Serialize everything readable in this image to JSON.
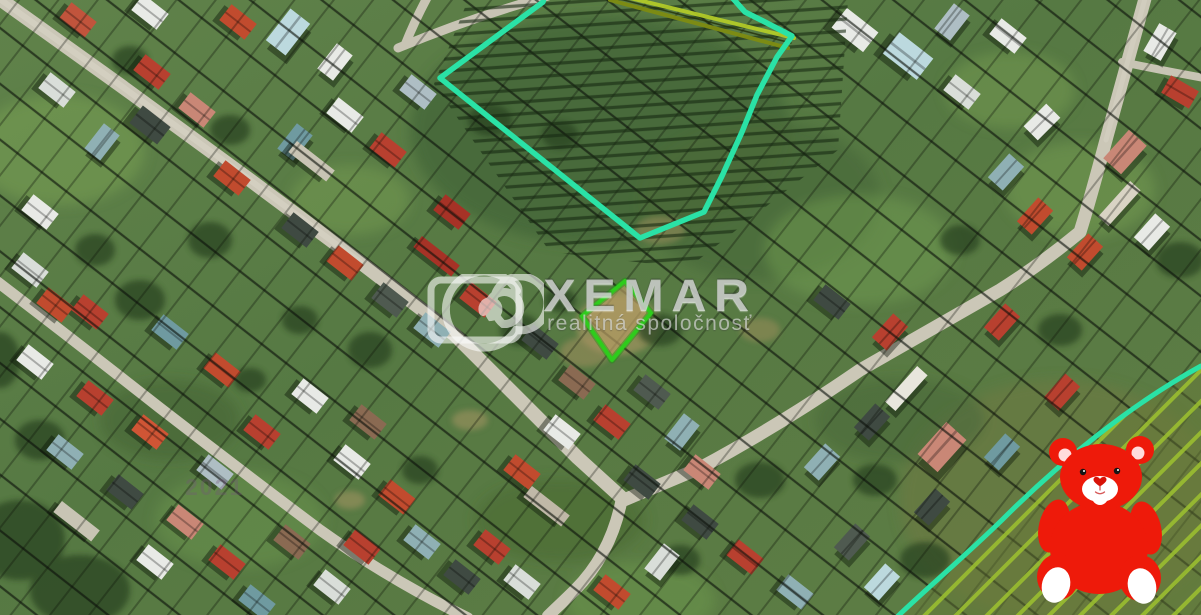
{
  "map": {
    "type": "satellite-cadastral-aerial",
    "imagery_year": "2021",
    "colors": {
      "highlight_outline": "#2ae2a6",
      "subject_outline": "#2ecc1c",
      "hatch": "#9dc22f",
      "parcel_line": "#0b100a"
    }
  },
  "watermark": {
    "title": "XEMAR",
    "subtitle": "realitná spoločnosť",
    "logo": "spiral-logo"
  },
  "mascot": {
    "name": "red-teddy-bear",
    "color": "#ee1a0a"
  }
}
